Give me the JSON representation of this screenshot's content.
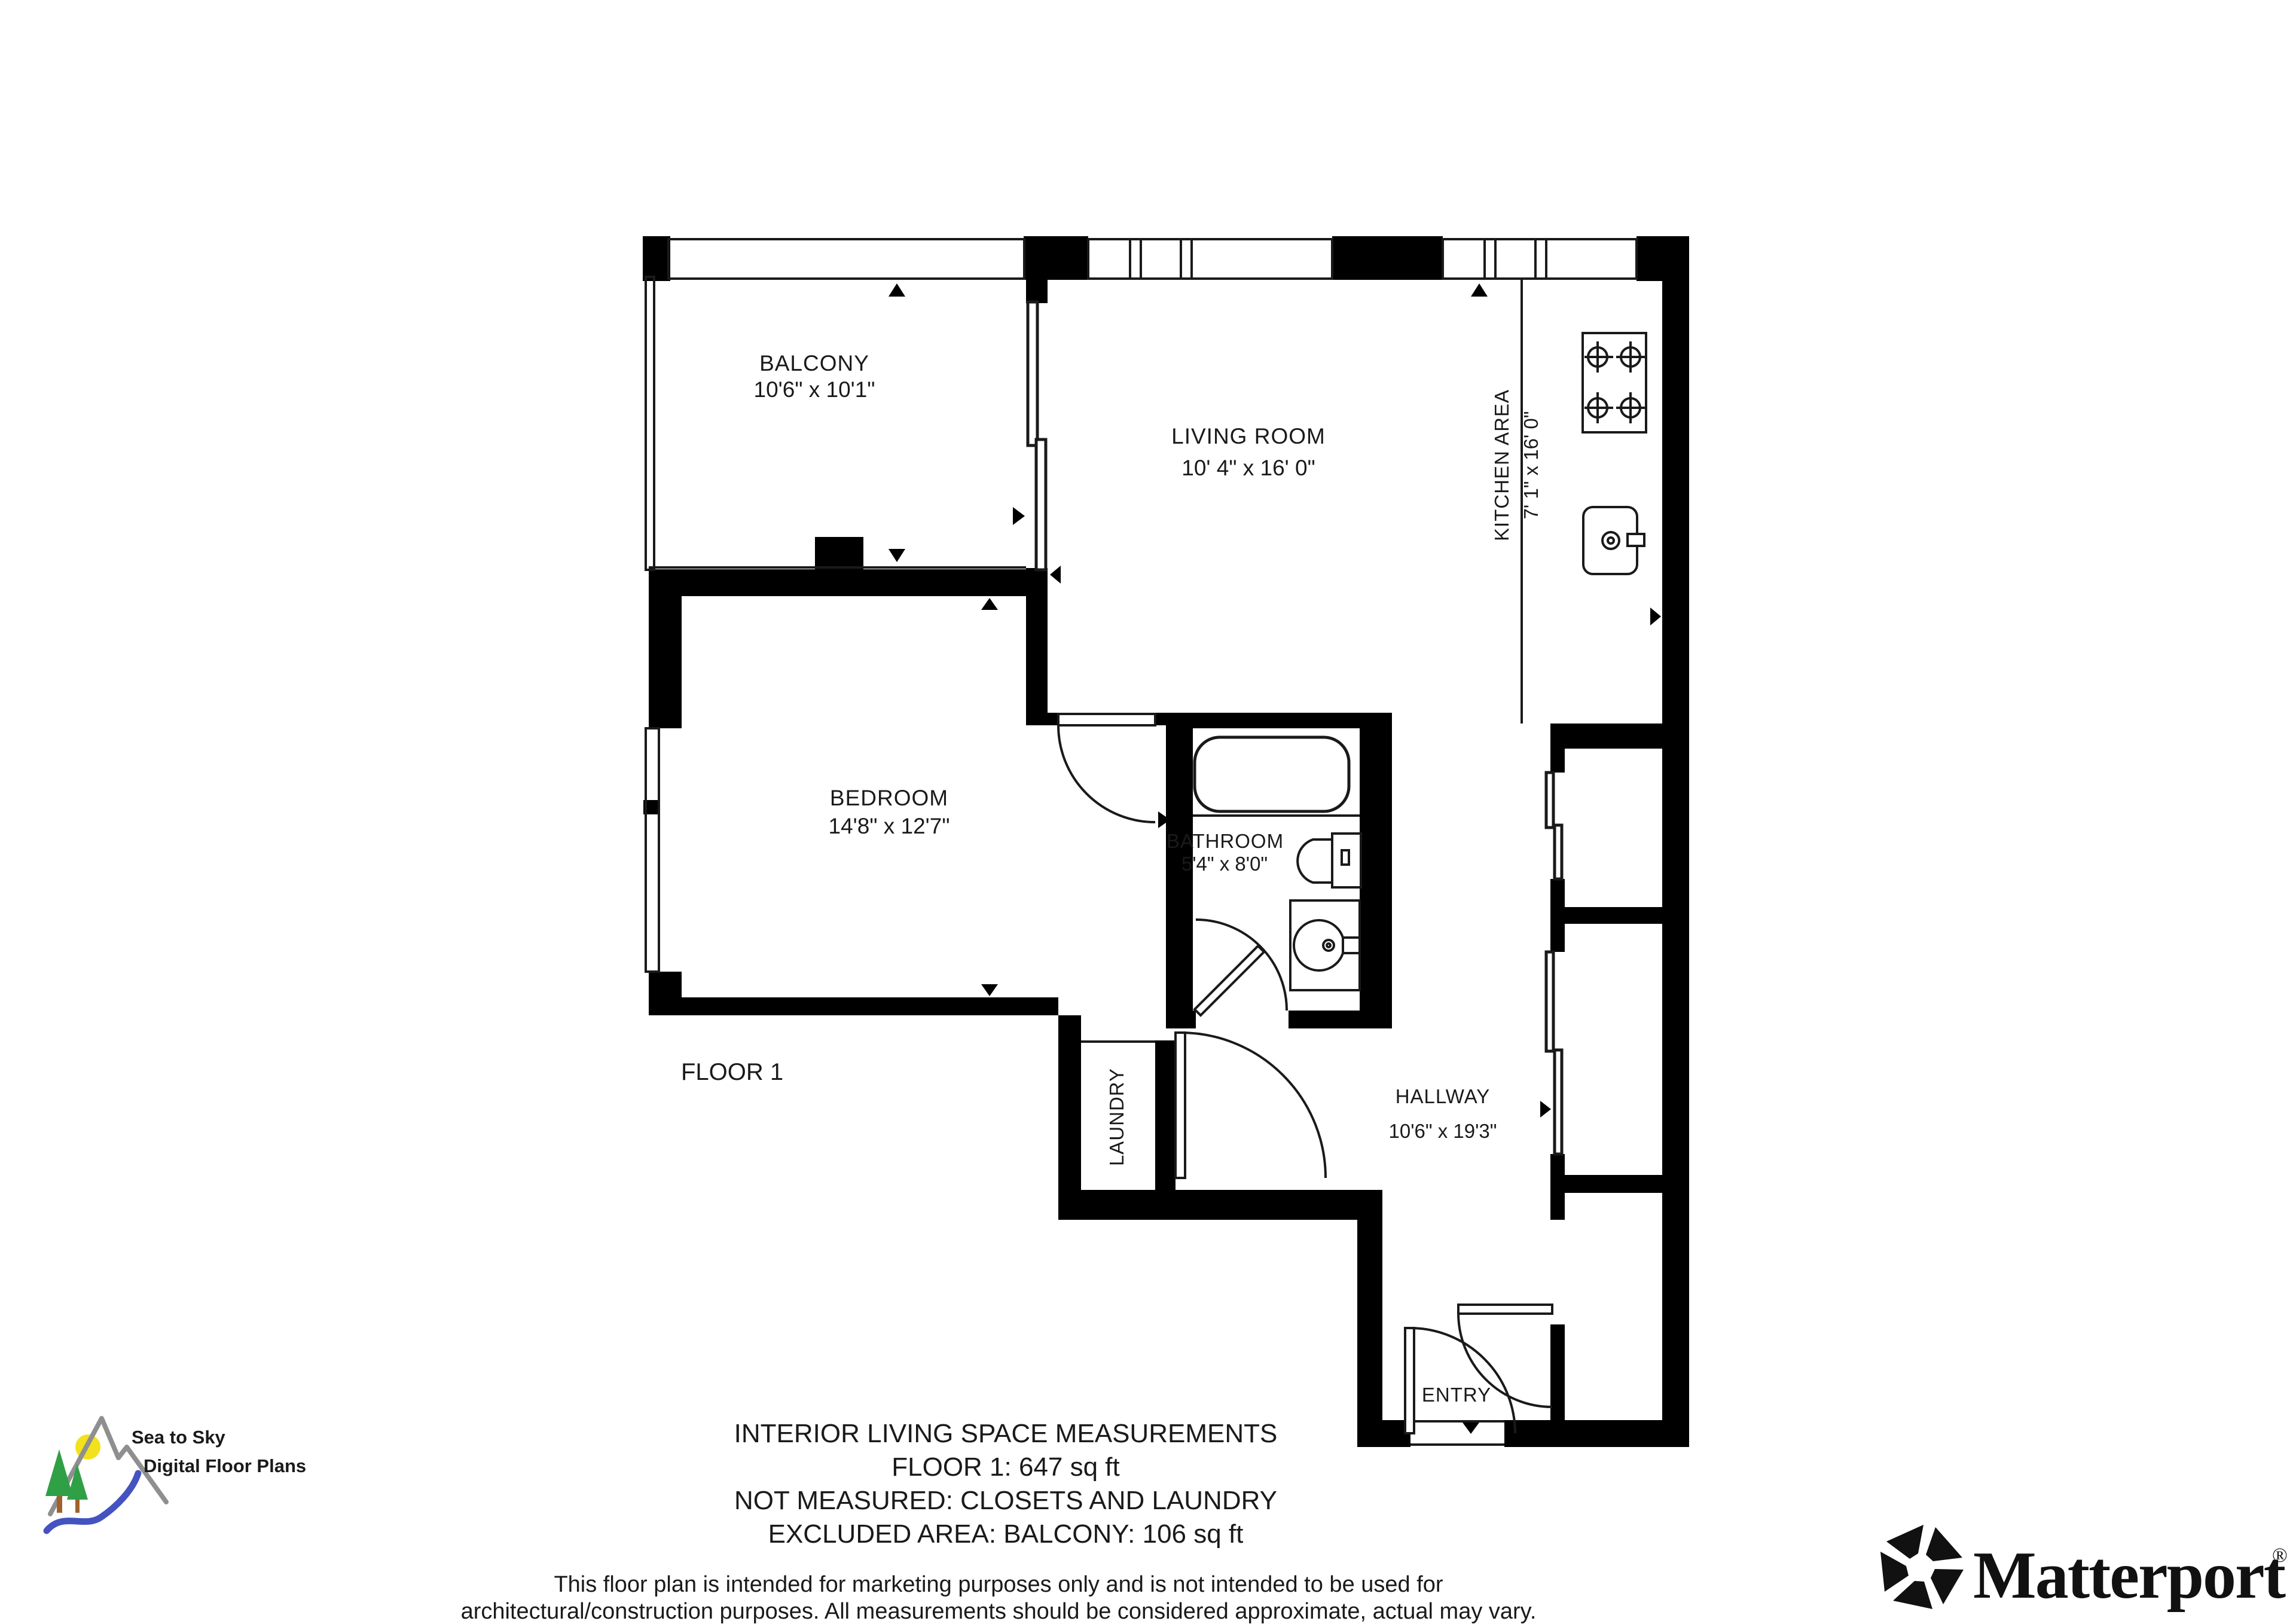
{
  "plan": {
    "floor_label": "FLOOR 1",
    "rooms": {
      "balcony": {
        "name": "BALCONY",
        "dims": "10'6\" x 10'1\""
      },
      "living_room": {
        "name": "LIVING ROOM",
        "dims": "10' 4\" x 16' 0\""
      },
      "kitchen": {
        "name": "KITCHEN AREA",
        "dims": "7' 1\" x 16' 0\""
      },
      "bedroom": {
        "name": "BEDROOM",
        "dims": "14'8\" x 12'7\""
      },
      "bathroom": {
        "name": "BATHROOM",
        "dims": "5'4\" x 8'0\""
      },
      "hallway": {
        "name": "HALLWAY",
        "dims": "10'6\" x 19'3\""
      },
      "laundry": {
        "name": "LAUNDRY"
      },
      "entry": {
        "name": "ENTRY"
      }
    }
  },
  "summary": {
    "line1": "INTERIOR LIVING SPACE MEASUREMENTS",
    "line2": "FLOOR 1: 647 sq ft",
    "line3": "NOT MEASURED: CLOSETS AND LAUNDRY",
    "line4": "EXCLUDED AREA: BALCONY: 106 sq ft"
  },
  "disclaimer": {
    "line1": "This floor plan is intended for marketing purposes only and is not intended to be used for",
    "line2": "architectural/construction purposes. All measurements should be considered approximate, actual may vary."
  },
  "branding": {
    "seatosky": {
      "line1": "Sea to Sky",
      "line2": "Digital Floor Plans"
    },
    "matterport": {
      "wordmark": "Matterport",
      "registered": "®"
    }
  },
  "colors": {
    "walls": "#000000",
    "lines": "#1a1a1a",
    "sun": "#f2e21b",
    "trees": "#2fa045",
    "trunk": "#a0622d",
    "river": "#4553c0",
    "mountain": "#8f8f8f"
  }
}
